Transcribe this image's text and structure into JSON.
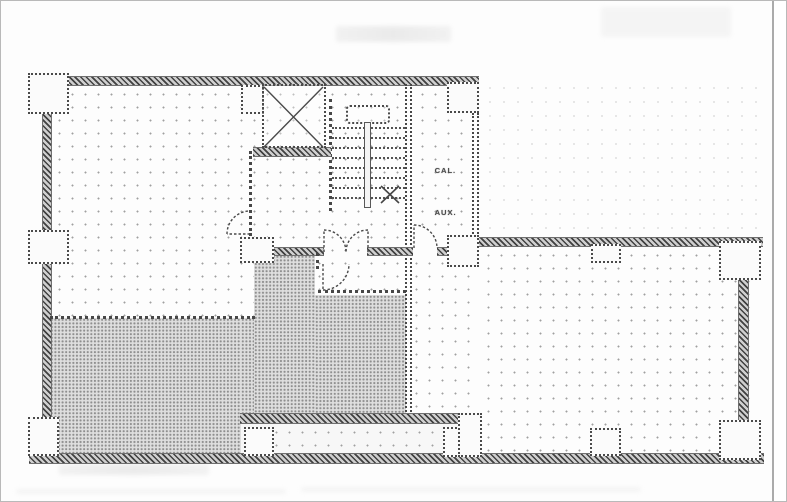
{
  "plan": {
    "kind": "scanned architectural floor plan",
    "room_labels": [
      {
        "id": "cal",
        "text": "CAL."
      },
      {
        "id": "aux",
        "text": "AUX."
      }
    ],
    "stair": {
      "tread_count": 8,
      "flight_divider": "center rail",
      "break_mark": "X"
    },
    "elevator": {
      "symbol": "crossed-diagonals shaft"
    },
    "ghost_text_regions": [
      "top-center",
      "top-right",
      "below-bottom-wall"
    ],
    "colors": {
      "paper": "#fdfdfd",
      "wall_ink": "#414141",
      "halftone_fill": "#dedede",
      "halftone_dot": "#8f8f8f",
      "stipple_dot": "#a0a0a0",
      "page_edge_line": "#8f8f8f"
    }
  }
}
